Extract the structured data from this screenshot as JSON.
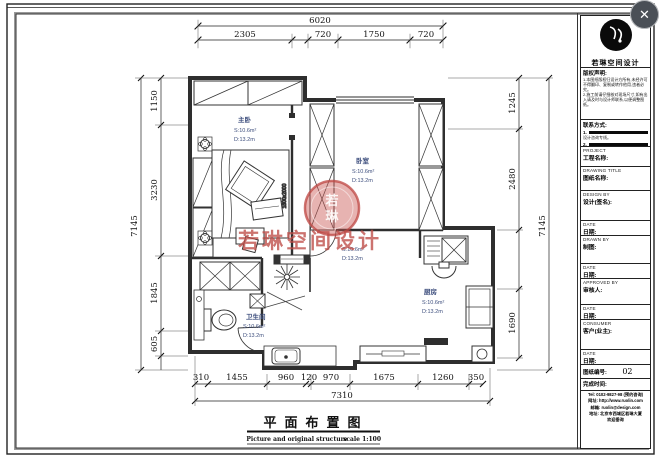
{
  "window": {
    "close": "✕"
  },
  "title_block": {
    "company": "若琳空间设计",
    "copyright_heading": "版权声明:",
    "copyright_items": [
      "1.本图纸版权归设计方所有,未经许可不得翻印、复制或转作他用,违者必究。",
      "2.施工前请仔细核对现场尺寸,如有出入请及时与设计师联系,以便调整图纸。"
    ],
    "links_heading": "联系方式:",
    "links": [
      {
        "num": "1.",
        "note": "设计咨询专线。"
      },
      {
        "num": "2.",
        "note": ""
      }
    ],
    "fields": [
      {
        "en": "PROJECT",
        "zh": "工程名称:"
      },
      {
        "en": "DRAWING TITLE",
        "zh": "图纸名称:"
      },
      {
        "en": "DESIGN BY",
        "zh": "设计(签名):"
      },
      {
        "en": "DATE",
        "zh": "日期:"
      },
      {
        "en": "DRAWN BY",
        "zh": "制图:"
      },
      {
        "en": "DATE",
        "zh": "日期:"
      },
      {
        "en": "APPROVED BY",
        "zh": "审核人:"
      },
      {
        "en": "DATE",
        "zh": "日期:"
      },
      {
        "en": "CONSUMER",
        "zh": "客户(业主):"
      },
      {
        "en": "DATE",
        "zh": "日期:"
      }
    ],
    "sheet_no_label": "图纸编号:",
    "sheet_no": "02",
    "finish_label": "完成时间:",
    "footer_lines": [
      "Tel: 0102-9827-98 (预约咨询)",
      "网址: http://www.ruolin.com",
      "邮箱: ruolin@design.com",
      "地址: 北京市西城区若琳大厦",
      "欢迎垂询"
    ]
  },
  "watermark": {
    "stamp_char_1": "若",
    "stamp_char_2": "琳",
    "text": "若琳空间设计"
  },
  "drawing": {
    "title": "平面布置图",
    "subtitle": "Picture and original structure",
    "scale": "scale 1:100",
    "bed_size": "1800x2000",
    "rooms": [
      {
        "name": "主卧",
        "s": "S:10.6m²",
        "d": "D:13.2m"
      },
      {
        "name": "卧室",
        "s": "S:10.6m²",
        "d": "D:13.2m"
      },
      {
        "name": "厨房",
        "s": "S:10.6m²",
        "d": "D:13.2m"
      },
      {
        "name": "卫生间",
        "s": "S:10.6m²",
        "d": "D:13.2m"
      },
      {
        "name": "",
        "s": "S:10.6m²",
        "d": "D:13.2m"
      }
    ],
    "dims": {
      "top_total": "6020",
      "top_chain": [
        "2305",
        "720",
        "1750",
        "720"
      ],
      "left_total": "7145",
      "left_chain": [
        "1150",
        "3230",
        "1845",
        "605"
      ],
      "right_total": "7145",
      "right_chain": [
        "1245",
        "2480",
        "1690"
      ],
      "bottom_total": "7310",
      "bottom_chain": [
        "310",
        "1455",
        "960",
        "120",
        "970",
        "1675",
        "1260",
        "350"
      ]
    }
  }
}
